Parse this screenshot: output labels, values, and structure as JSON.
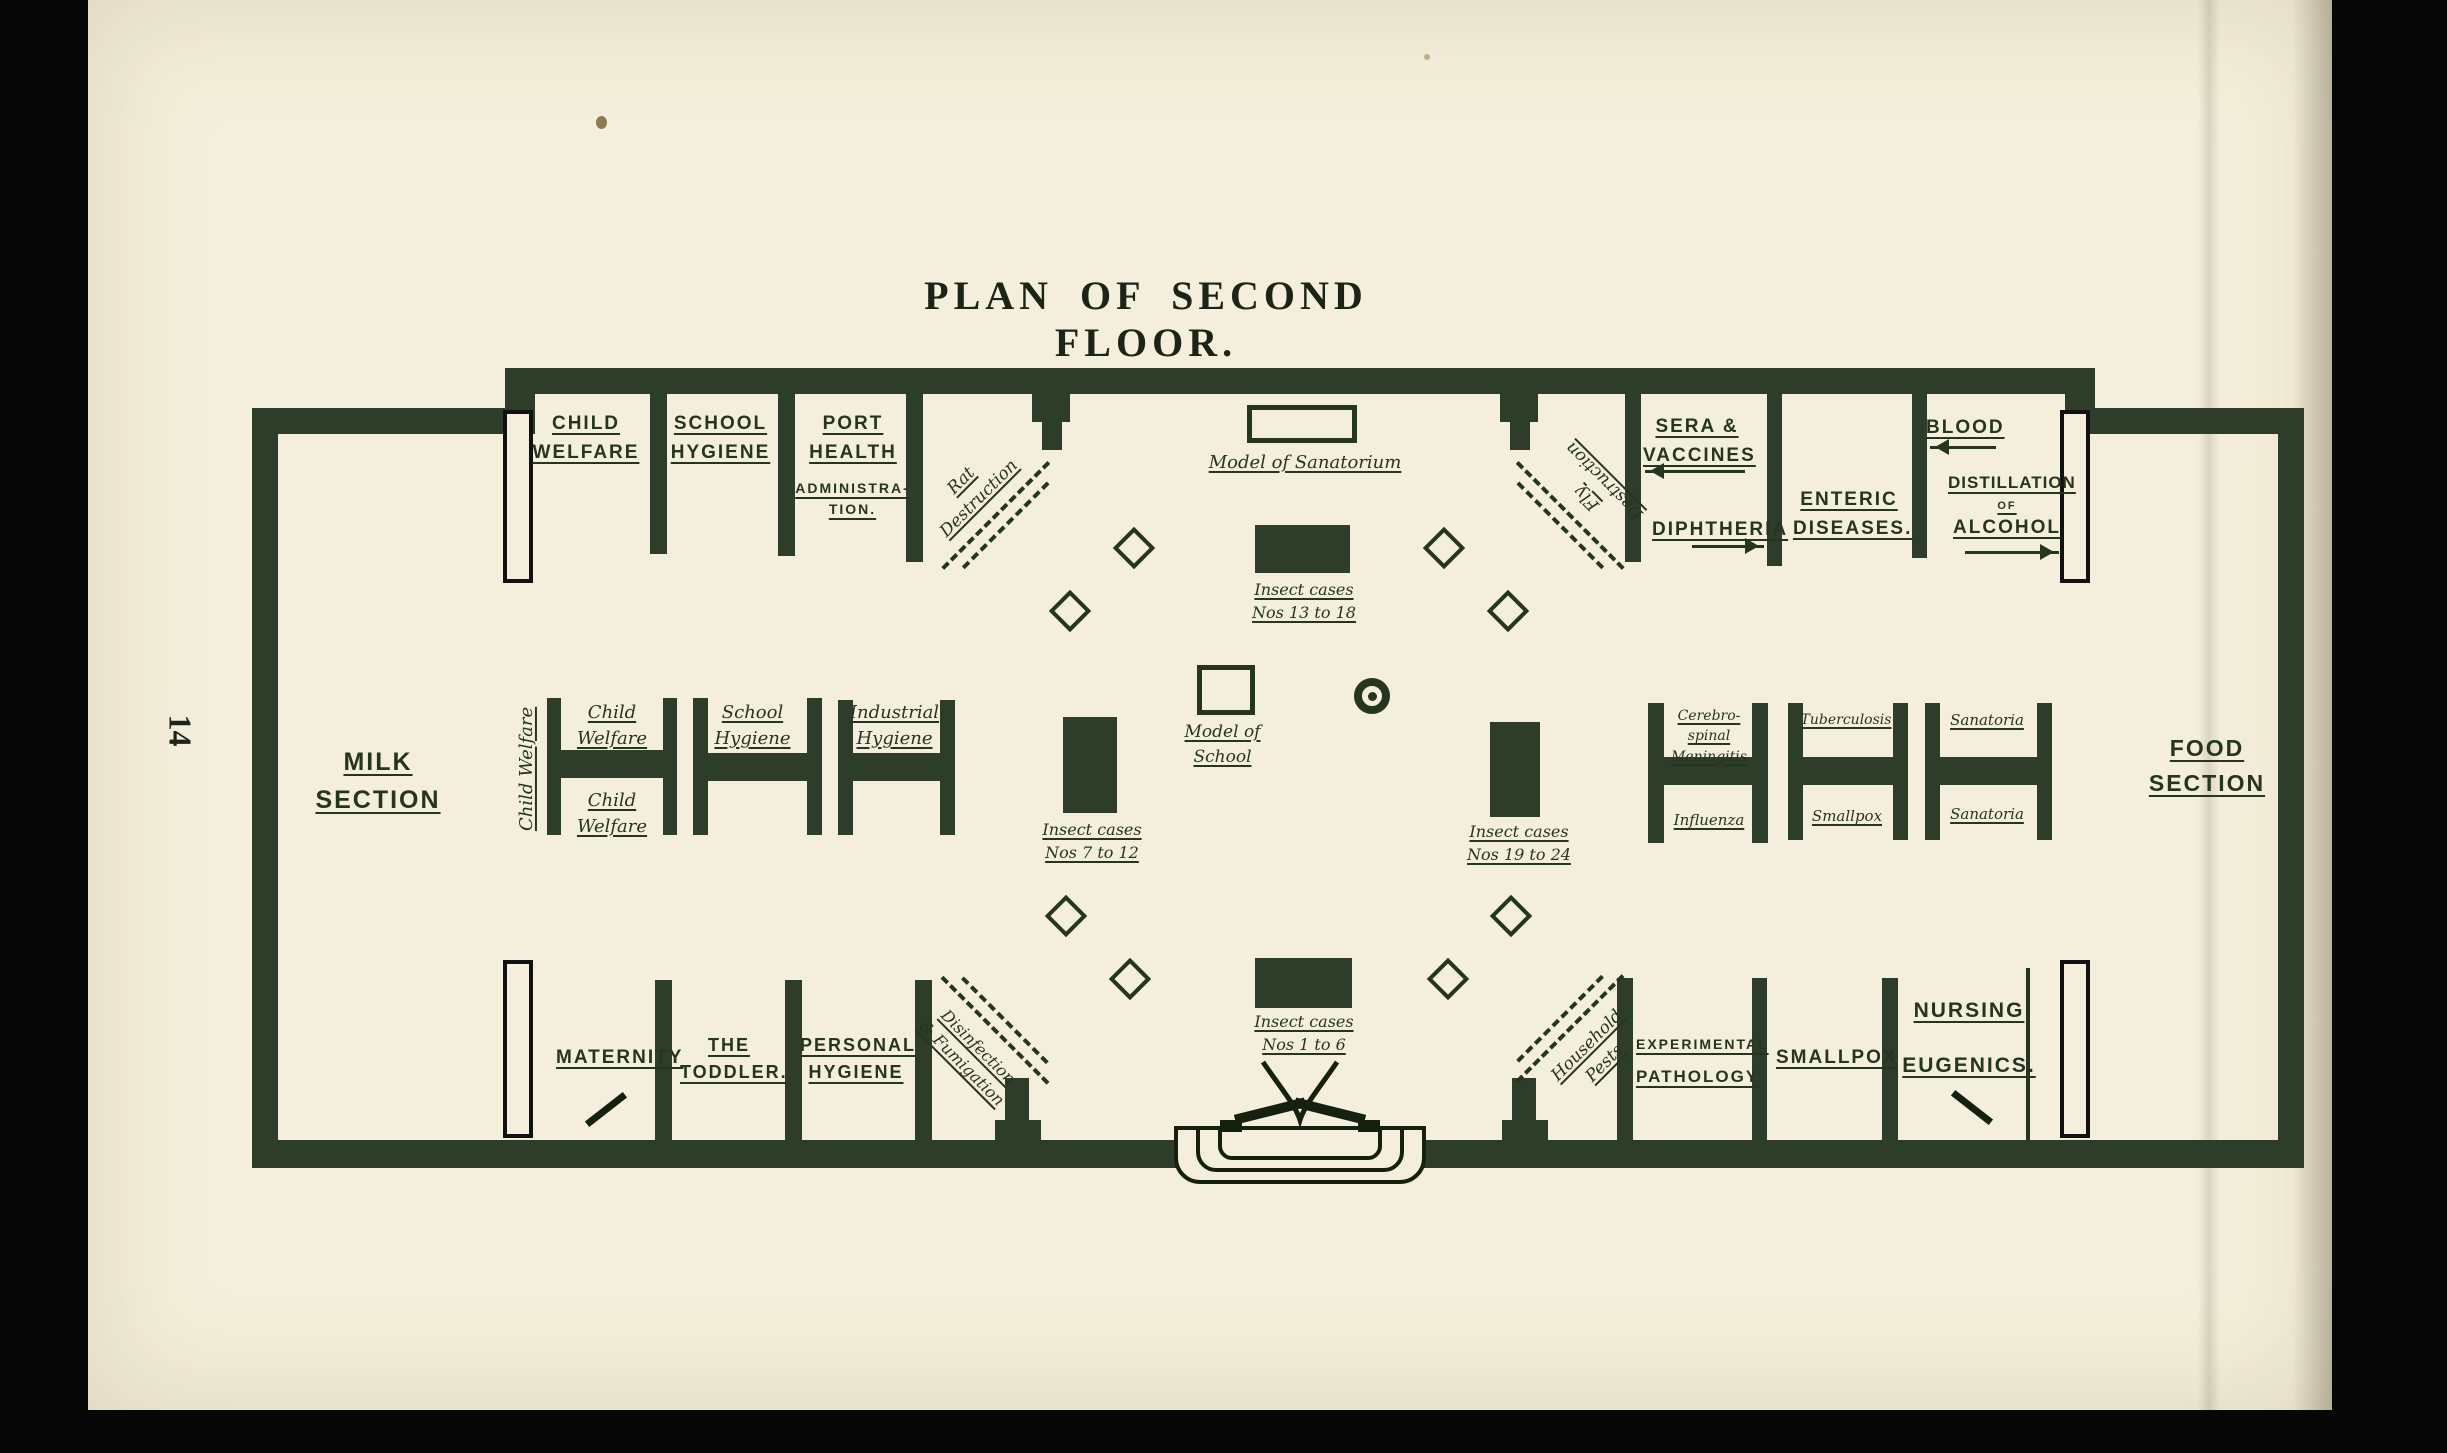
{
  "colors": {
    "paper": "#f4efdc",
    "ink": "#26351f",
    "wall": "#2e3d2a",
    "backdrop": "#070707"
  },
  "page": {
    "number": "14",
    "title": "PLAN OF SECOND FLOOR."
  },
  "rooms": {
    "child_welfare": "CHILD\nWELFARE",
    "school_hygiene": "SCHOOL\nHYGIENE",
    "port_health_main": "PORT\nHEALTH",
    "port_health_sub": "ADMINISTRA-\nTION.",
    "sera_vaccines": "SERA &\nVACCINES",
    "diphtheria": "DIPHTHERIA",
    "enteric": "ENTERIC\nDISEASES.",
    "blood": "BLOOD",
    "distillation_line1": "DISTILLATION",
    "distillation_line2": "OF",
    "distillation_line3": "ALCOHOL",
    "milk": "MILK\nSECTION",
    "food": "FOOD\nSECTION",
    "maternity": "MATERNITY",
    "toddler": "THE\nTODDLER.",
    "personal_hygiene": "PERSONAL\nHYGIENE",
    "experimental_line1": "EXPERIMENTAL",
    "experimental_line2": "PATHOLOGY",
    "smallpox": "SMALLPOX",
    "nursing_eugenics": "NURSING\nEUGENICS."
  },
  "staircases": {
    "top_left": "Rat\nDestruction",
    "top_right": "Fly\nDestruction",
    "bottom_left": "Disinfection\n& Fumigation",
    "bottom_right": "Household\nPests"
  },
  "stands": {
    "side_label": "Child Welfare",
    "h1_top": "Child\nWelfare",
    "h1_bottom": "Child\nWelfare",
    "h2_top": "School\nHygiene",
    "h3_top": "Industrial\nHygiene",
    "h4_top": "Cerebro-\nspinal\nMeningitis",
    "h4_bottom": "Influenza",
    "h5_top": "Tuberculosis",
    "h5_bottom": "Smallpox",
    "h6_top": "Sanatoria",
    "h6_bottom": "Sanatoria"
  },
  "exhibits": {
    "model_sanatorium": "Model of Sanatorium",
    "model_school": "Model of School",
    "cases_13_18": "Insect cases\nNos 13 to 18",
    "cases_7_12": "Insect cases\nNos 7 to 12",
    "cases_19_24": "Insect cases\nNos 19 to 24",
    "cases_1_6": "Insect cases\nNos 1 to 6"
  },
  "icons": {
    "sera_arrow": "arrow-left",
    "diphtheria_arrow": "arrow-right",
    "blood_arrow": "arrow-left",
    "alcohol_arrow": "arrow-right"
  }
}
